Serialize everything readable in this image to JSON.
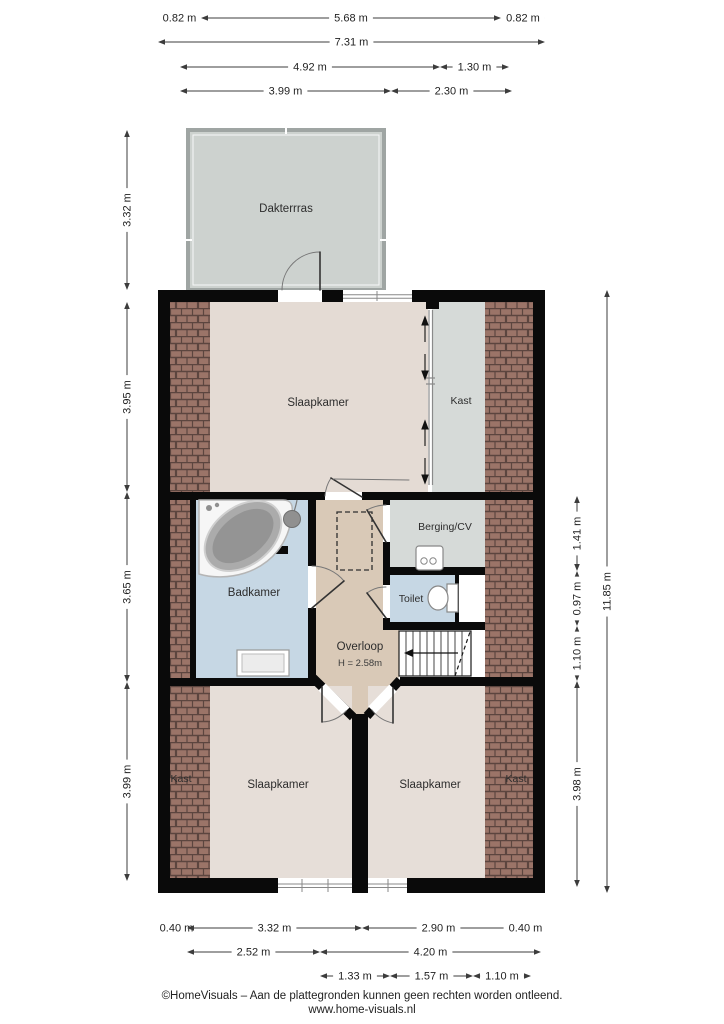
{
  "meta": {
    "type": "floorplan",
    "footer_line1": "©HomeVisuals – Aan de plattegronden kunnen geen rechten worden ontleend.",
    "footer_line2": "www.home-visuals.nl"
  },
  "rooms": {
    "dakterras": "Dakterrras",
    "slaapkamer_top": "Slaapkamer",
    "kast_top": "Kast",
    "badkamer": "Badkamer",
    "berging_cv": "Berging/CV",
    "toilet": "Toilet",
    "overloop": "Overloop",
    "overloop_height": "H = 2.58m",
    "slaapkamer_bottom_left": "Slaapkamer",
    "slaapkamer_bottom_right": "Slaapkamer",
    "kast_bottom_left": "Kast",
    "kast_bottom_right": "Kast"
  },
  "colors": {
    "wall": "#0a0a0a",
    "floor_bedroom": "#e4dbd4",
    "floor_landing": "#d9c9b7",
    "floor_bath": "#c6d7e4",
    "floor_storage": "#d6dad8",
    "terrace_floor": "#cdd2cf",
    "terrace_wall": "#9fa5a3",
    "roof_brick": "#9b7468",
    "roof_brick_line": "#5c453f",
    "dimension_line": "#3c3c3c"
  },
  "dimensions": {
    "horizontal": [
      {
        "label": "0.82 m",
        "x1": 158,
        "x2": 201,
        "y": 18
      },
      {
        "label": "5.68 m",
        "x1": 201,
        "x2": 501,
        "y": 18
      },
      {
        "label": "0.82 m",
        "x1": 501,
        "x2": 545,
        "y": 18
      },
      {
        "label": "7.31 m",
        "x1": 158,
        "x2": 545,
        "y": 42
      },
      {
        "label": "4.92 m",
        "x1": 180,
        "x2": 440,
        "y": 67
      },
      {
        "label": "1.30 m",
        "x1": 440,
        "x2": 509,
        "y": 67
      },
      {
        "label": "3.99 m",
        "x1": 180,
        "x2": 391,
        "y": 91
      },
      {
        "label": "2.30 m",
        "x1": 391,
        "x2": 512,
        "y": 91
      },
      {
        "label": "0.40 m",
        "x1": 166,
        "x2": 187,
        "y": 928
      },
      {
        "label": "3.32 m",
        "x1": 187,
        "x2": 362,
        "y": 928
      },
      {
        "label": "2.90 m",
        "x1": 362,
        "x2": 515,
        "y": 928
      },
      {
        "label": "0.40 m",
        "x1": 515,
        "x2": 536,
        "y": 928
      },
      {
        "label": "2.52 m",
        "x1": 187,
        "x2": 320,
        "y": 952
      },
      {
        "label": "4.20 m",
        "x1": 320,
        "x2": 541,
        "y": 952
      },
      {
        "label": "1.33 m",
        "x1": 320,
        "x2": 390,
        "y": 976
      },
      {
        "label": "1.57 m",
        "x1": 390,
        "x2": 473,
        "y": 976
      },
      {
        "label": "1.10 m",
        "x1": 473,
        "x2": 531,
        "y": 976
      }
    ],
    "vertical": [
      {
        "label": "3.32 m",
        "y1": 130,
        "y2": 290,
        "x": 127
      },
      {
        "label": "3.95 m",
        "y1": 302,
        "y2": 492,
        "x": 127
      },
      {
        "label": "3.65 m",
        "y1": 492,
        "y2": 682,
        "x": 127
      },
      {
        "label": "3.99 m",
        "y1": 682,
        "y2": 881,
        "x": 127
      },
      {
        "label": "1.41 m",
        "y1": 496,
        "y2": 571,
        "x": 577
      },
      {
        "label": "0.97 m",
        "y1": 571,
        "y2": 626,
        "x": 577
      },
      {
        "label": "1.10 m",
        "y1": 626,
        "y2": 681,
        "x": 577
      },
      {
        "label": "3.98 m",
        "y1": 681,
        "y2": 887,
        "x": 577
      },
      {
        "label": "11.85 m",
        "y1": 290,
        "y2": 893,
        "x": 607
      }
    ]
  }
}
